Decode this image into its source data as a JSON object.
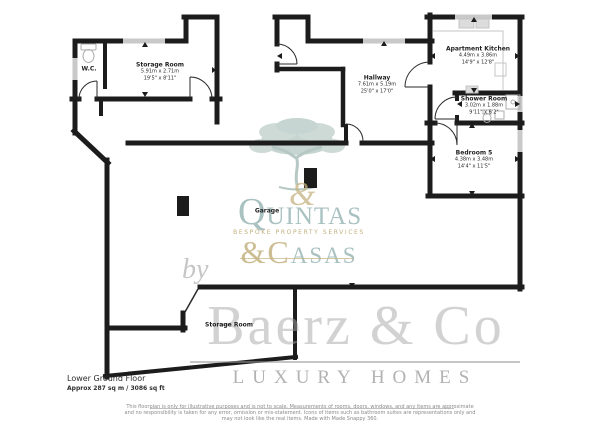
{
  "footer": {
    "floor_label": "Lower Ground Floor",
    "area_label": "Approx 287 sq m / 3086 sq ft"
  },
  "rooms": {
    "wc": {
      "name": "W.C."
    },
    "storage": {
      "name": "Storage Room",
      "metric": "5.91m x 2.71m",
      "imperial": "19'5\" x 8'11\""
    },
    "hallway": {
      "name": "Hallway",
      "metric": "7.61m x 5.19m",
      "imperial": "25'0\" x 17'0\""
    },
    "kitchen": {
      "name": "Apartment Kitchen",
      "metric": "4.49m x 3.86m",
      "imperial": "14'9\" x 12'8\""
    },
    "shower": {
      "name": "Shower Room",
      "metric": "3.02m x 1.88m",
      "imperial": "9'11\" x 6'2\""
    },
    "bedroom": {
      "name": "Bedroom 5",
      "metric": "4.38m x 3.48m",
      "imperial": "14'4\" x 11'5\""
    },
    "garage": {
      "name": "Garage"
    },
    "storage2": {
      "name": "Storage Room"
    }
  },
  "watermarks": {
    "agency": {
      "name_top": "QUINTAS",
      "amp": "&",
      "name_bottom": "&CASAS",
      "tagline": "BESPOKE PROPERTY SERVICES"
    },
    "brand": {
      "prefix": "by",
      "name": "Baerz & Co",
      "subtitle": "LUXURY HOMES"
    }
  },
  "disclaimer": {
    "line1": "This floorplan is only for illustrative purposes and is not to scale. Measurements of rooms, doors, windows, and any items are approximate",
    "line2": "and no responsibility is taken for any error, omission or mis-statement. Icons of items such as bathroom suites are representations only and",
    "line3": "may not look like the real items. Made with Made Snappy 360."
  },
  "colors": {
    "wall": "#1c1c1c",
    "window": "#c9c9c9",
    "agency_teal": "#94b2b2",
    "agency_gold": "#c4b280",
    "brand_gray": "#a5a5a5"
  }
}
